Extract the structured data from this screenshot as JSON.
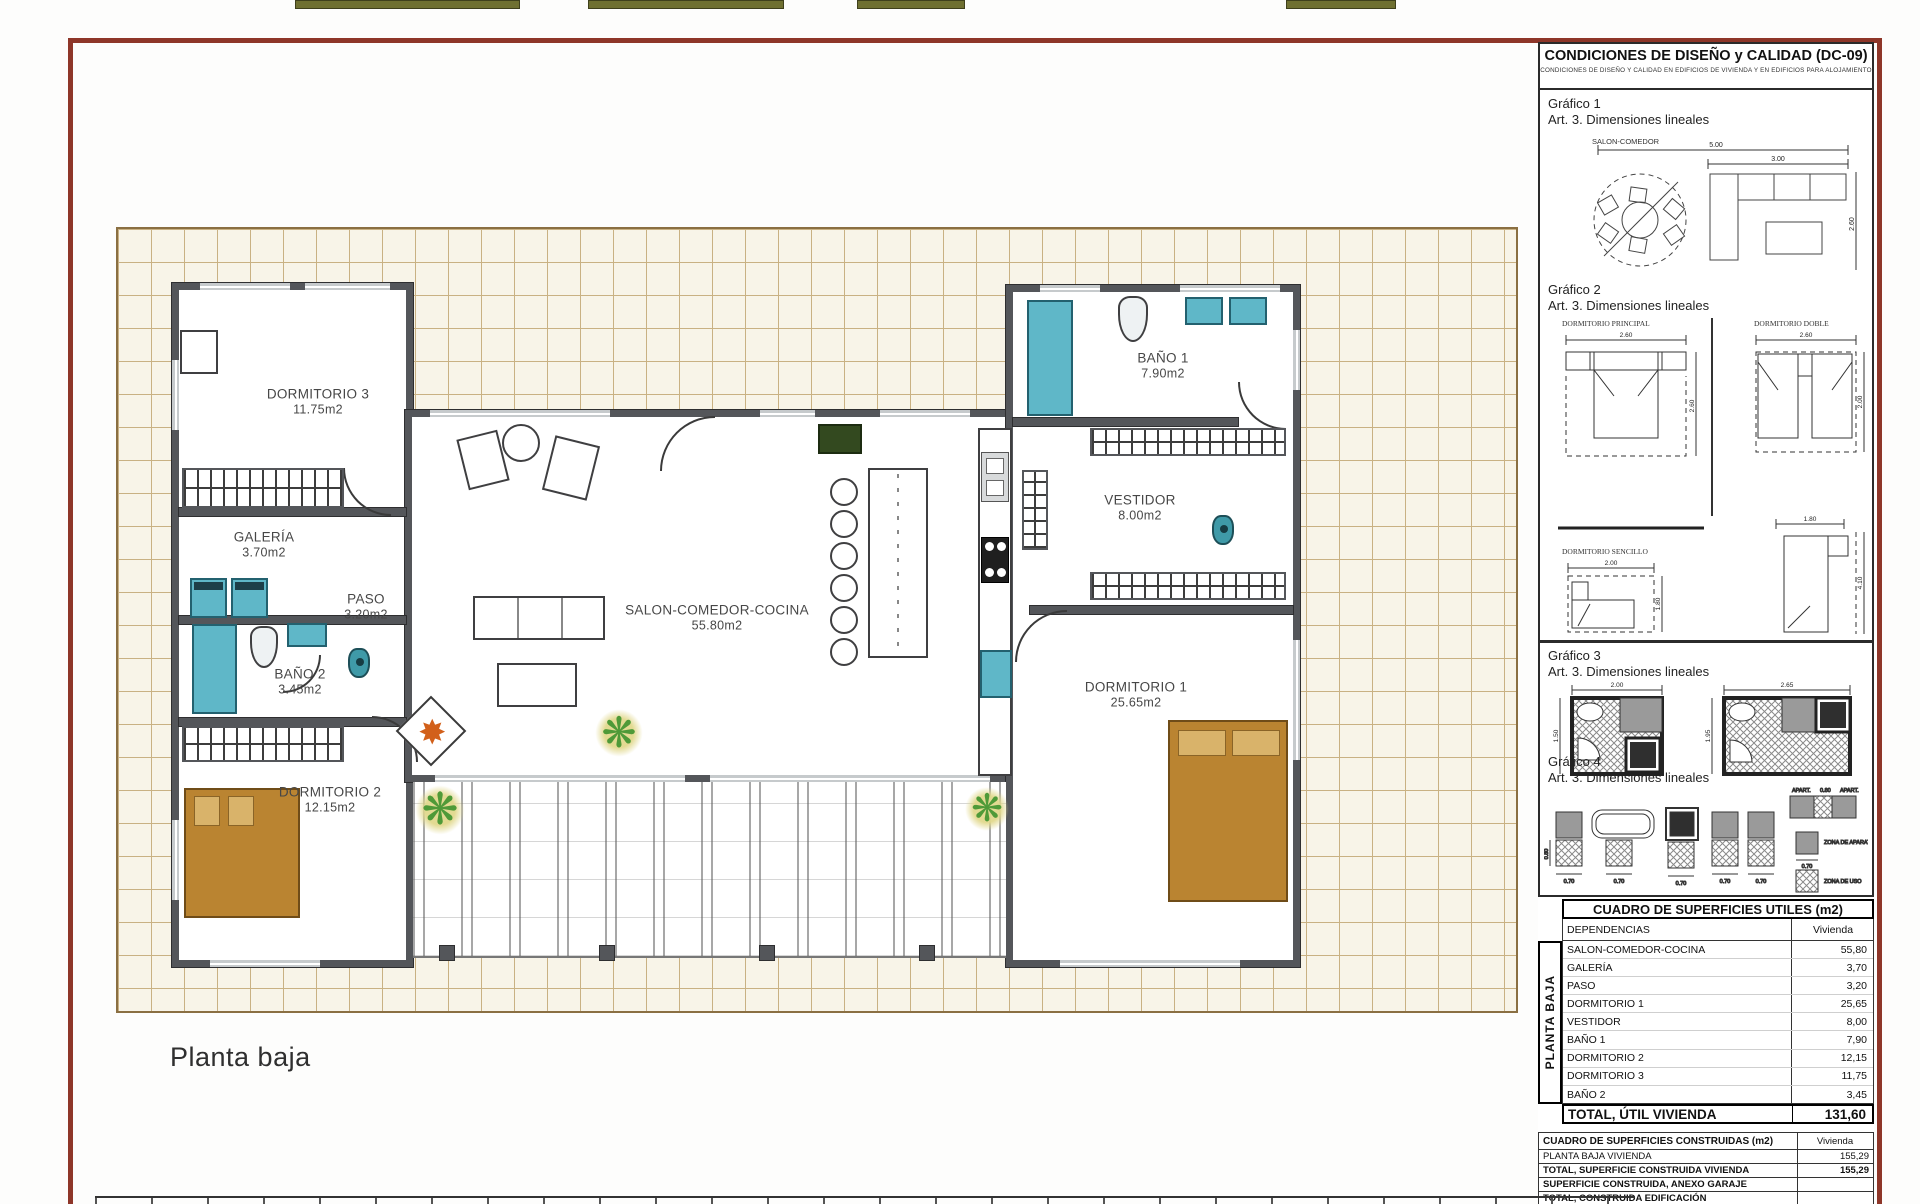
{
  "plan": {
    "label": "Planta baja",
    "rooms": [
      {
        "name": "DORMITORIO 3",
        "area": "11.75m2"
      },
      {
        "name": "GALERÍA",
        "area": "3.70m2"
      },
      {
        "name": "PASO",
        "area": "3.20m2"
      },
      {
        "name": "BAÑO 2",
        "area": "3.45m2"
      },
      {
        "name": "DORMITORIO 2",
        "area": "12.15m2"
      },
      {
        "name": "SALON-COMEDOR-COCINA",
        "area": "55.80m2"
      },
      {
        "name": "BAÑO 1",
        "area": "7.90m2"
      },
      {
        "name": "VESTIDOR",
        "area": "8.00m2"
      },
      {
        "name": "DORMITORIO 1",
        "area": "25.65m2"
      }
    ]
  },
  "sidebar": {
    "title": "CONDICIONES DE DISEÑO y CALIDAD (DC-09)",
    "subtitle": "CONDICIONES DE DISEÑO Y CALIDAD EN EDIFICIOS DE VIVIENDA Y EN EDIFICIOS PARA ALOJAMIENTO",
    "grafico1": {
      "title": "Gráfico 1",
      "subtitle": "Art. 3. Dimensiones lineales",
      "caption": "SALON-COMEDOR",
      "dim_total": "5.00",
      "dim_sofa": "3.00",
      "dim_height": "2.60"
    },
    "grafico2": {
      "title": "Gráfico 2",
      "subtitle": "Art. 3. Dimensiones lineales",
      "caption_principal": "DORMITORIO PRINCIPAL",
      "caption_doble": "DORMITORIO DOBLE",
      "caption_sencillo": "DORMITORIO SENCILLO",
      "dim_principal_w": "2.60",
      "dim_principal_h": "2.60",
      "dim_doble_w": "2.60",
      "dim_doble_h": "2.00",
      "dim_sencillo_w": "2.00",
      "dim_sencillo_h": "1.80",
      "dim_single_w": "1.80",
      "dim_single_h": "4.10"
    },
    "grafico3": {
      "title": "Gráfico 3",
      "subtitle": "Art. 3. Dimensiones lineales",
      "dim_left_w": "2.00",
      "dim_left_h": "1.50",
      "dim_right_w": "2.65",
      "dim_right_h": "1.95"
    },
    "grafico4": {
      "title": "Gráfico 4",
      "subtitle": "Art. 3. Dimensiones lineales",
      "dim_small": "0.70",
      "dim_large": "0.80",
      "dim_060": "0.60",
      "apart": "APART.",
      "legend_aparato": "ZONA DE APARATO",
      "legend_uso": "ZONA DE USO"
    },
    "table_utiles": {
      "title": "CUADRO DE SUPERFICIES UTILES (m2)",
      "col_dependencias": "DEPENDENCIAS",
      "col_vivienda": "Vivienda",
      "row_group": "PLANTA BAJA",
      "rows": [
        {
          "name": "SALON-COMEDOR-COCINA",
          "value": "55,80"
        },
        {
          "name": "GALERÍA",
          "value": "3,70"
        },
        {
          "name": "PASO",
          "value": "3,20"
        },
        {
          "name": "DORMITORIO 1",
          "value": "25,65"
        },
        {
          "name": "VESTIDOR",
          "value": "8,00"
        },
        {
          "name": "BAÑO 1",
          "value": "7,90"
        },
        {
          "name": "DORMITORIO 2",
          "value": "12,15"
        },
        {
          "name": "DORMITORIO 3",
          "value": "11,75"
        },
        {
          "name": "BAÑO 2",
          "value": "3,45"
        }
      ],
      "total_label": "TOTAL, ÚTIL VIVIENDA",
      "total_value": "131,60"
    },
    "table_construidas": {
      "title": "CUADRO DE SUPERFICIES CONSTRUIDAS (m2)",
      "col_vivienda": "Vivienda",
      "rows": [
        {
          "name": "PLANTA BAJA VIVIENDA",
          "value": "155,29"
        },
        {
          "name": "TOTAL, SUPERFICIE CONSTRUIDA VIVIENDA",
          "value": "155,29"
        },
        {
          "name": "SUPERFICIE CONSTRUIDA, ANEXO GARAJE",
          "value": ""
        },
        {
          "name": "TOTAL, CONSTRUIDA EDIFICACIÓN",
          "value": ""
        }
      ]
    }
  },
  "colors": {
    "frame": "#8e3629",
    "tile_line": "#c9b183",
    "wall": "#54565a",
    "fixture_teal": "#5fb7c8",
    "bed_brown": "#ba8431",
    "plant_green": "#4f9a38",
    "flame_orange": "#d2601a",
    "olive": "#6f7031"
  }
}
